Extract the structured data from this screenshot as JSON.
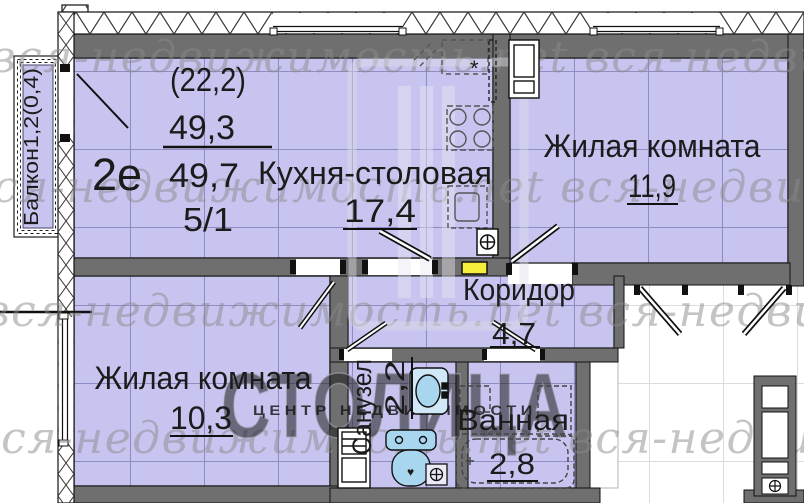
{
  "plan": {
    "unit_label": "2е",
    "stats": {
      "secondary_area": "(22,2)",
      "living_area": "49,3",
      "total_area": "49,7",
      "floor": "5/1"
    },
    "rooms": [
      {
        "name": "Кухня-столовая",
        "area": "17,4"
      },
      {
        "name": "Жилая комната",
        "area": "11,9"
      },
      {
        "name": "Коридор",
        "area": "4,7"
      },
      {
        "name": "Жилая комната",
        "area": "10,3"
      },
      {
        "name": "Санузел",
        "area": "2,2"
      },
      {
        "name": "Ванная",
        "area": "2,8"
      }
    ],
    "balcony_label": "Балкон1,2(0,4)",
    "glyphs": {
      "asterisk": "*",
      "heart": "♥"
    }
  },
  "watermark": {
    "row": "вся-недвижимость.пet  вся-недвижимост",
    "logo": "СТОЛИЦА",
    "logo_sub": "ЦЕНТР НЕДВИЖИМОСТИ"
  },
  "colors": {
    "room_fill": "#c7c5f0",
    "wall": "#6f6f6f",
    "panel_yellow": "#f5ee3a",
    "fixture_blue": "#a9d6ef"
  }
}
